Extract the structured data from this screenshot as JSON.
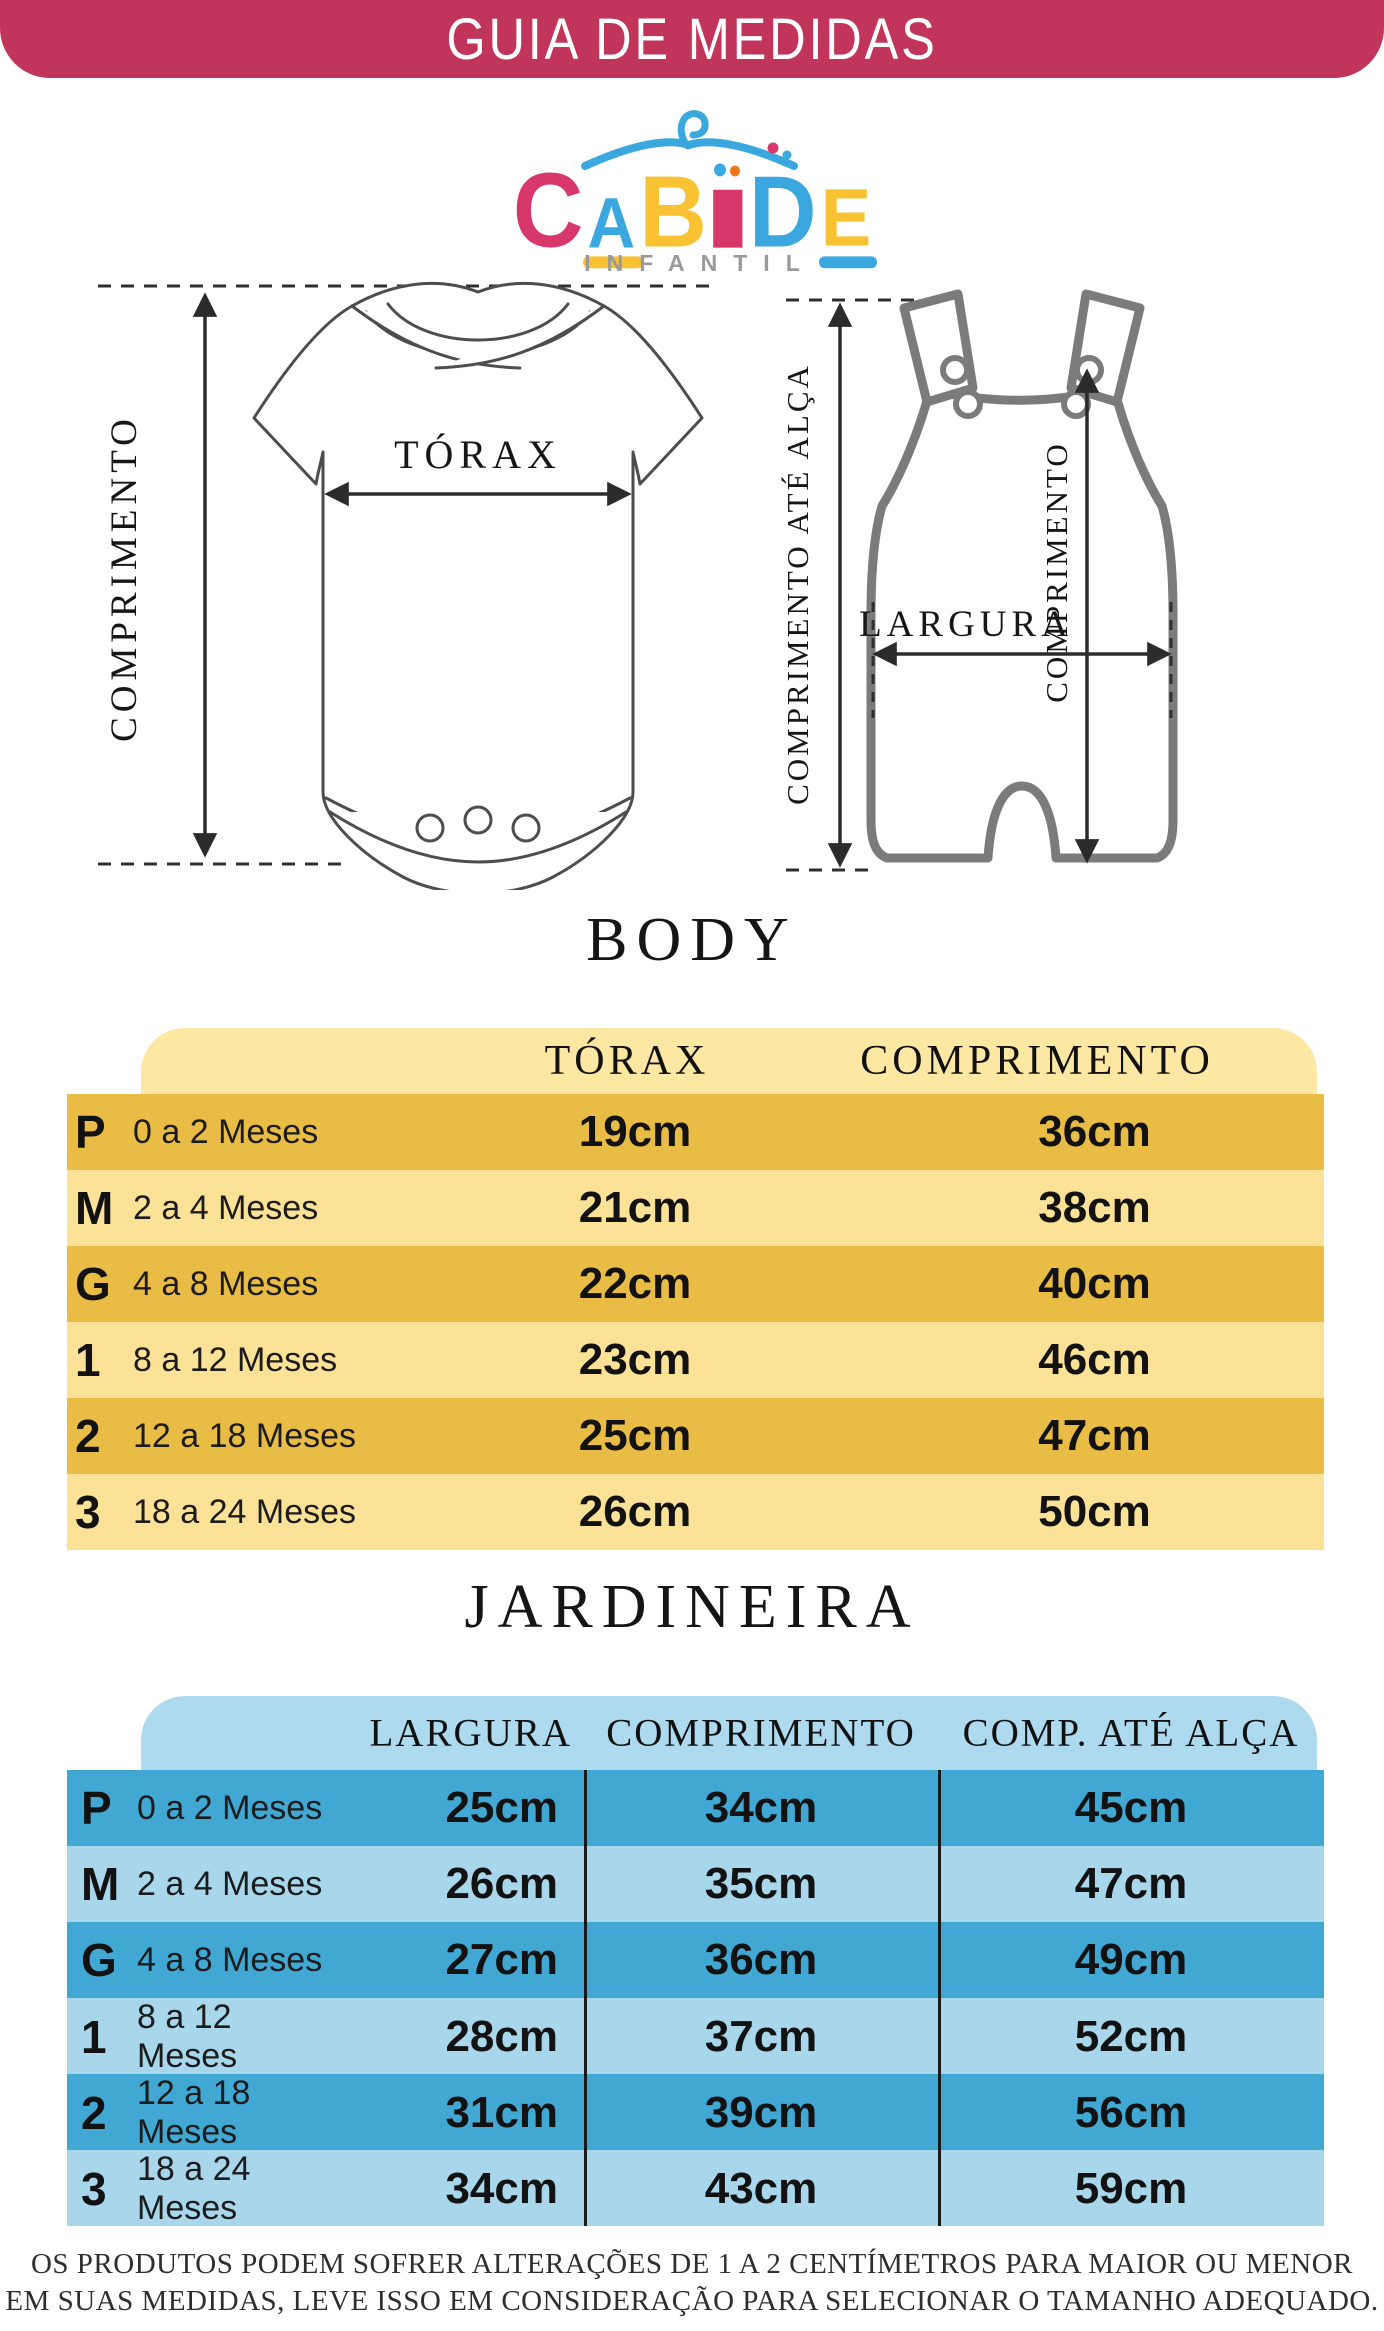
{
  "banner": {
    "title": "GUIA DE MEDIDAS"
  },
  "logo": {
    "letters": [
      {
        "ch": "C",
        "color": "#D8376C"
      },
      {
        "ch": "A",
        "color": "#3BA7DF"
      },
      {
        "ch": "B",
        "color": "#F8C232"
      },
      {
        "ch": "I",
        "color": "#D8376C"
      },
      {
        "ch": "D",
        "color": "#3BA7DF"
      },
      {
        "ch": "E",
        "color": "#F8C232"
      }
    ],
    "subtitle": "INFANTIL"
  },
  "diagrams": {
    "body": {
      "length_label": "COMPRIMENTO",
      "chest_label": "TÓRAX"
    },
    "overalls": {
      "strap_length_label": "COMPRIMENTO ATÉ ALÇA",
      "length_label": "COMPRIMENTO",
      "width_label": "LARGURA"
    }
  },
  "body_table": {
    "title": "BODY",
    "columns": [
      "TÓRAX",
      "COMPRIMENTO"
    ],
    "rows": [
      {
        "size": "P",
        "age": "0 a 2 Meses",
        "torax": "19cm",
        "comprimento": "36cm"
      },
      {
        "size": "M",
        "age": "2 a 4 Meses",
        "torax": "21cm",
        "comprimento": "38cm"
      },
      {
        "size": "G",
        "age": "4 a 8 Meses",
        "torax": "22cm",
        "comprimento": "40cm"
      },
      {
        "size": "1",
        "age": "8 a 12 Meses",
        "torax": "23cm",
        "comprimento": "46cm"
      },
      {
        "size": "2",
        "age": "12 a 18 Meses",
        "torax": "25cm",
        "comprimento": "47cm"
      },
      {
        "size": "3",
        "age": "18 a 24 Meses",
        "torax": "26cm",
        "comprimento": "50cm"
      }
    ]
  },
  "jardineira_table": {
    "title": "JARDINEIRA",
    "columns": [
      "LARGURA",
      "COMPRIMENTO",
      "COMP. ATÉ ALÇA"
    ],
    "rows": [
      {
        "size": "P",
        "age": "0 a 2 Meses",
        "largura": "25cm",
        "comprimento": "34cm",
        "alca": "45cm"
      },
      {
        "size": "M",
        "age": "2 a 4 Meses",
        "largura": "26cm",
        "comprimento": "35cm",
        "alca": "47cm"
      },
      {
        "size": "G",
        "age": "4 a 8 Meses",
        "largura": "27cm",
        "comprimento": "36cm",
        "alca": "49cm"
      },
      {
        "size": "1",
        "age": "8 a 12 Meses",
        "largura": "28cm",
        "comprimento": "37cm",
        "alca": "52cm"
      },
      {
        "size": "2",
        "age": "12 a 18 Meses",
        "largura": "31cm",
        "comprimento": "39cm",
        "alca": "56cm"
      },
      {
        "size": "3",
        "age": "18 a 24 Meses",
        "largura": "34cm",
        "comprimento": "43cm",
        "alca": "59cm"
      }
    ]
  },
  "footer": {
    "line1": "OS PRODUTOS PODEM SOFRER ALTERAÇÕES DE 1 A 2 CENTÍMETROS PARA MAIOR OU MENOR",
    "line2": "EM SUAS MEDIDAS, LEVE ISSO EM CONSIDERAÇÃO PARA SELECIONAR O TAMANHO ADEQUADO."
  },
  "colors": {
    "banner_bg": "#C2355B",
    "gold_dark": "#E9BC45",
    "gold_light": "#FBE297",
    "gold_header": "#FCE8A3",
    "blue_dark": "#41A8D3",
    "blue_light": "#A8D7EC",
    "blue_header": "#ADDAEE",
    "logo_pink": "#D8376C",
    "logo_blue": "#3BA7DF",
    "logo_yellow": "#F8C232",
    "logo_orange": "#F07818"
  }
}
